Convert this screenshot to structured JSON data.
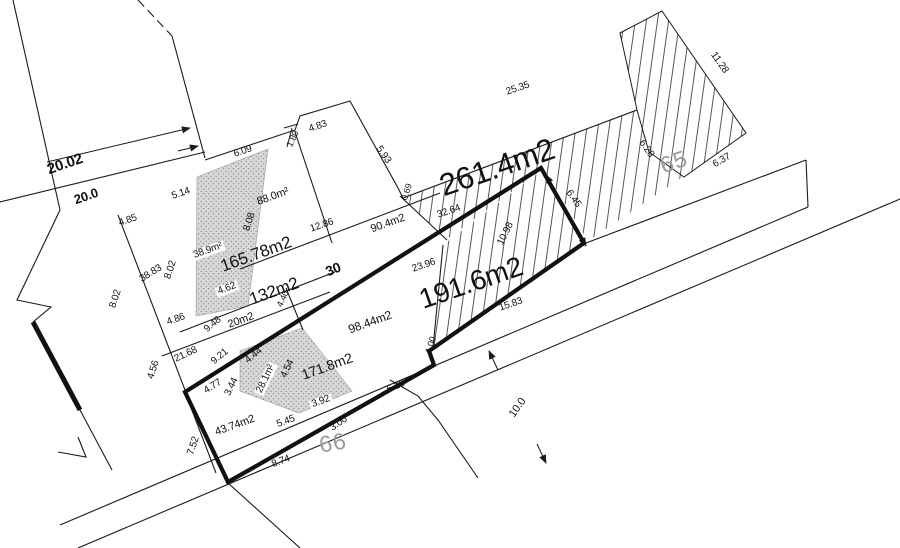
{
  "drawing": {
    "title": "cadastral-parcel-plan",
    "colors": {
      "line": "#1a1a1a",
      "parcel_number_gray": "#9b9b9b",
      "hatch": "#444444",
      "stipple_fill": "#d8d8d8",
      "stipple_dot": "#8f8f8f"
    },
    "parcel_ids": [
      {
        "text": "65",
        "x": 674,
        "y": 162,
        "rot": -19,
        "size": 23
      },
      {
        "text": "66",
        "x": 333,
        "y": 443,
        "rot": -10,
        "size": 23
      }
    ],
    "area_labels": [
      {
        "text": "261.4m2",
        "x": 497,
        "y": 167,
        "rot": -19,
        "size": 31
      },
      {
        "text": "191.6m2",
        "x": 471,
        "y": 283,
        "rot": -19,
        "size": 28
      },
      {
        "text": "165.78m2",
        "x": 256,
        "y": 254,
        "rot": -20,
        "size": 17
      },
      {
        "text": "132m2",
        "x": 274,
        "y": 291,
        "rot": -20,
        "size": 17
      },
      {
        "text": "171.8m2",
        "x": 327,
        "y": 366,
        "rot": -20,
        "size": 14
      },
      {
        "text": "98.44m2",
        "x": 370,
        "y": 322,
        "rot": -20,
        "size": 12
      },
      {
        "text": "90.4m2",
        "x": 388,
        "y": 224,
        "rot": -20,
        "size": 11
      },
      {
        "text": "88.0m²",
        "x": 273,
        "y": 197,
        "rot": -20,
        "size": 11
      },
      {
        "text": "43.74m2",
        "x": 235,
        "y": 426,
        "rot": -20,
        "size": 11
      },
      {
        "text": "20m2",
        "x": 241,
        "y": 321,
        "rot": -20,
        "size": 11
      },
      {
        "text": "38.9m²",
        "x": 208,
        "y": 251,
        "rot": -20,
        "size": 10,
        "bg": true
      },
      {
        "text": "28.1m²",
        "x": 266,
        "y": 379,
        "rot": -64,
        "size": 10,
        "bg": true
      }
    ],
    "bold_dimensions": [
      {
        "text": "20.02",
        "x": 65,
        "y": 164,
        "rot": -19,
        "size": 15
      },
      {
        "text": "20.0",
        "x": 86,
        "y": 196,
        "rot": -19,
        "size": 13
      },
      {
        "text": "30",
        "x": 333,
        "y": 269,
        "rot": -22,
        "size": 14
      }
    ],
    "dimension_labels": [
      {
        "text": "6.09",
        "x": 243,
        "y": 152,
        "rot": -19,
        "size": 10
      },
      {
        "text": "4.83",
        "x": 318,
        "y": 127,
        "rot": -19,
        "size": 10
      },
      {
        "text": "1.80",
        "x": 293,
        "y": 139,
        "rot": -64,
        "size": 9
      },
      {
        "text": "5.93",
        "x": 383,
        "y": 155,
        "rot": 55,
        "size": 10
      },
      {
        "text": "0.69",
        "x": 407,
        "y": 192,
        "rot": -72,
        "size": 9
      },
      {
        "text": "5.14",
        "x": 181,
        "y": 194,
        "rot": -19,
        "size": 10
      },
      {
        "text": "4.85",
        "x": 128,
        "y": 221,
        "rot": -19,
        "size": 10
      },
      {
        "text": "38.83",
        "x": 151,
        "y": 274,
        "rot": -32,
        "size": 10
      },
      {
        "text": "8.02",
        "x": 171,
        "y": 270,
        "rot": -72,
        "size": 10
      },
      {
        "text": "8.02",
        "x": 116,
        "y": 299,
        "rot": -72,
        "size": 10
      },
      {
        "text": "8.08",
        "x": 250,
        "y": 222,
        "rot": -72,
        "size": 10
      },
      {
        "text": "12.86",
        "x": 322,
        "y": 226,
        "rot": -19,
        "size": 10
      },
      {
        "text": "32.64",
        "x": 449,
        "y": 212,
        "rot": -19,
        "size": 10
      },
      {
        "text": "25.35",
        "x": 518,
        "y": 89,
        "rot": -19,
        "size": 10
      },
      {
        "text": "23.96",
        "x": 424,
        "y": 266,
        "rot": -19,
        "size": 10
      },
      {
        "text": "10.98",
        "x": 506,
        "y": 234,
        "rot": -64,
        "size": 10
      },
      {
        "text": "6.45",
        "x": 573,
        "y": 199,
        "rot": 55,
        "size": 10
      },
      {
        "text": "11.28",
        "x": 719,
        "y": 63,
        "rot": 55,
        "size": 10
      },
      {
        "text": "6.28",
        "x": 646,
        "y": 149,
        "rot": 55,
        "size": 10
      },
      {
        "text": "6.37",
        "x": 722,
        "y": 161,
        "rot": -30,
        "size": 10
      },
      {
        "text": "15.83",
        "x": 511,
        "y": 305,
        "rot": -19,
        "size": 10
      },
      {
        "text": "1.00",
        "x": 431,
        "y": 345,
        "rot": -72,
        "size": 9
      },
      {
        "text": "4.86",
        "x": 176,
        "y": 320,
        "rot": -19,
        "size": 10
      },
      {
        "text": "9.48",
        "x": 213,
        "y": 325,
        "rot": -40,
        "size": 10
      },
      {
        "text": "21.68",
        "x": 186,
        "y": 355,
        "rot": -25,
        "size": 10
      },
      {
        "text": "9.21",
        "x": 220,
        "y": 357,
        "rot": -40,
        "size": 10
      },
      {
        "text": "4.40",
        "x": 283,
        "y": 299,
        "rot": -64,
        "size": 9
      },
      {
        "text": "4.62",
        "x": 227,
        "y": 289,
        "rot": -20,
        "size": 10,
        "bg": true
      },
      {
        "text": "4.44",
        "x": 254,
        "y": 356,
        "rot": -40,
        "size": 10
      },
      {
        "text": "4.54",
        "x": 288,
        "y": 369,
        "rot": -64,
        "size": 10
      },
      {
        "text": "4.77",
        "x": 213,
        "y": 387,
        "rot": -32,
        "size": 10
      },
      {
        "text": "3.44",
        "x": 232,
        "y": 387,
        "rot": -64,
        "size": 10
      },
      {
        "text": "4.56",
        "x": 154,
        "y": 370,
        "rot": -72,
        "size": 10
      },
      {
        "text": "7.52",
        "x": 194,
        "y": 446,
        "rot": -72,
        "size": 10
      },
      {
        "text": "5.45",
        "x": 286,
        "y": 422,
        "rot": -20,
        "size": 10
      },
      {
        "text": "3.92",
        "x": 321,
        "y": 402,
        "rot": -20,
        "size": 10,
        "bg": true
      },
      {
        "text": "3.00",
        "x": 339,
        "y": 424,
        "rot": -35,
        "size": 10
      },
      {
        "text": "8.74",
        "x": 281,
        "y": 462,
        "rot": -20,
        "size": 10
      },
      {
        "text": "6.26",
        "x": 396,
        "y": 387,
        "rot": -22,
        "size": 10
      },
      {
        "text": "10.0",
        "x": 518,
        "y": 408,
        "rot": -55,
        "size": 11
      }
    ]
  }
}
